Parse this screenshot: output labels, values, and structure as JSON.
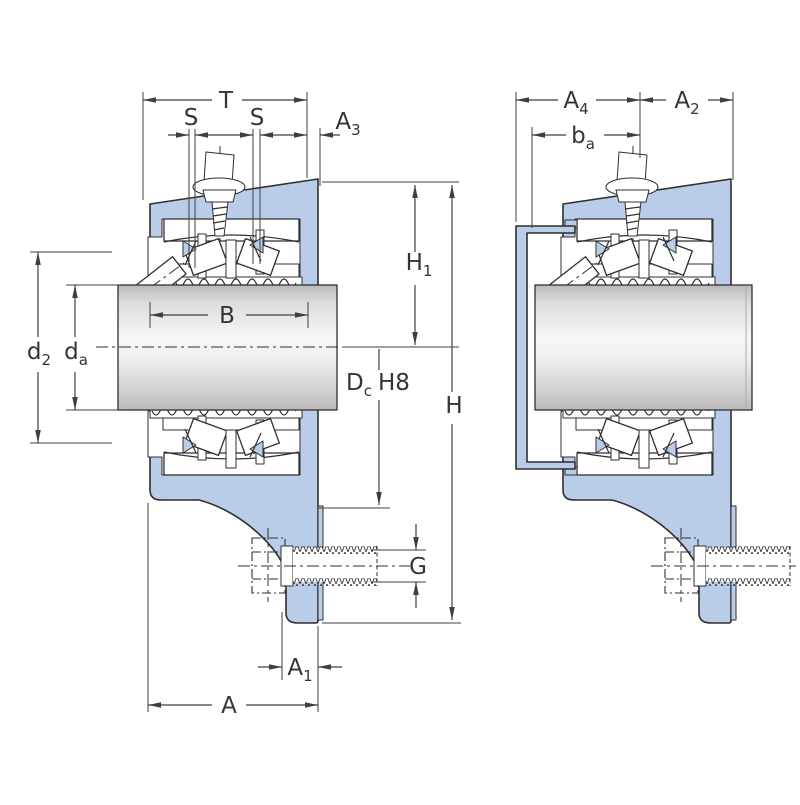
{
  "drawing": {
    "type": "technical-cross-section",
    "subject": "flanged bearing housing units with shaft"
  },
  "colors": {
    "housing_fill": "#b9cce8",
    "outline": "#2f2f2f",
    "dimension_line": "#3f3f3f",
    "label_text": "#353535",
    "shaft_highlight": "#f7f7f7",
    "shaft_shadow": "#b9b9b9",
    "background": "#ffffff"
  },
  "dims": {
    "t": {
      "main": "T"
    },
    "s1": {
      "main": "S"
    },
    "s2": {
      "main": "S"
    },
    "a3": {
      "main": "A",
      "sub": "3"
    },
    "a4": {
      "main": "A",
      "sub": "4"
    },
    "a2": {
      "main": "A",
      "sub": "2"
    },
    "ba": {
      "main": "b",
      "sub": "a"
    },
    "h1": {
      "main": "H",
      "sub": "1"
    },
    "h": {
      "main": "H"
    },
    "b": {
      "main": "B"
    },
    "d2": {
      "main": "d",
      "sub": "2"
    },
    "da": {
      "main": "d",
      "sub": "a"
    },
    "dc": {
      "main": "D",
      "sub": "c",
      "suffix": "H8"
    },
    "g": {
      "main": "G"
    },
    "a1": {
      "main": "A",
      "sub": "1"
    },
    "a": {
      "main": "A"
    }
  }
}
